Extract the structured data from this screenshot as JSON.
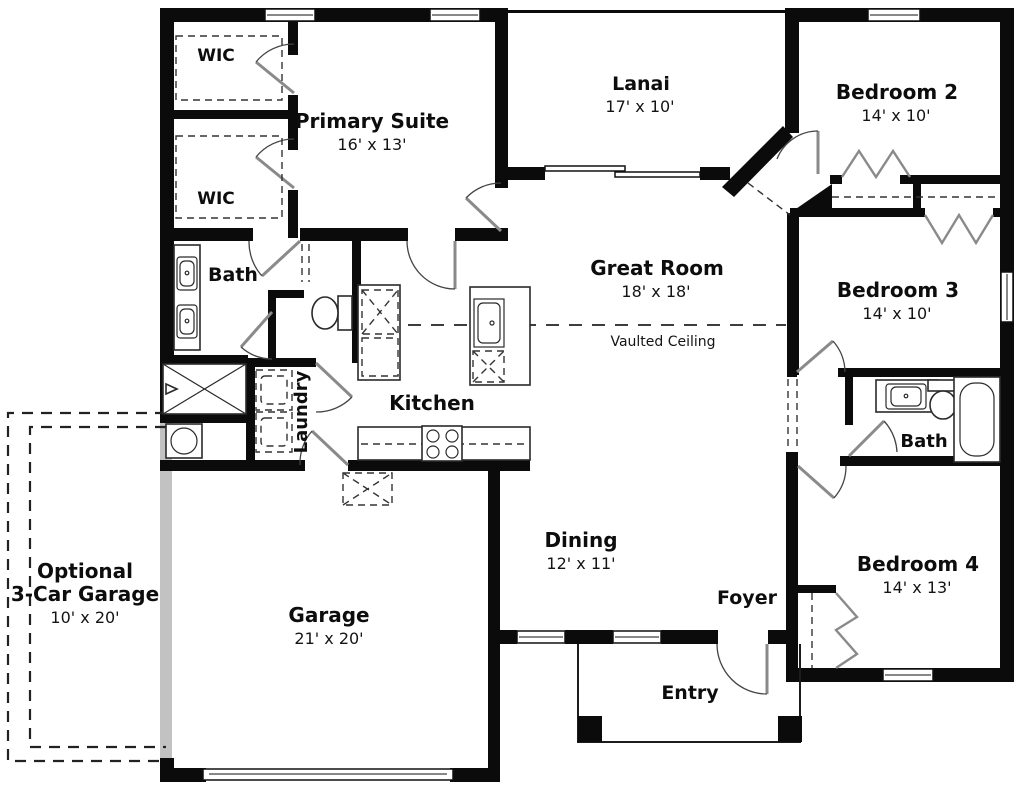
{
  "plan": {
    "title": "Single-story house floor plan",
    "colors": {
      "wall": "#0b0b0b",
      "optional_garage_wall": "#c2c2c2",
      "background": "#ffffff"
    },
    "rooms": {
      "wic1": {
        "name": "WIC"
      },
      "wic2": {
        "name": "WIC"
      },
      "primary": {
        "name": "Primary Suite",
        "dims": "16' x 13'"
      },
      "lanai": {
        "name": "Lanai",
        "dims": "17' x 10'"
      },
      "bedroom2": {
        "name": "Bedroom 2",
        "dims": "14' x 10'"
      },
      "great_room": {
        "name": "Great Room",
        "dims": "18' x 18'",
        "note": "Vaulted Ceiling"
      },
      "bedroom3": {
        "name": "Bedroom 3",
        "dims": "14' x 10'"
      },
      "bath1": {
        "name": "Bath"
      },
      "bath2": {
        "name": "Bath"
      },
      "laundry": {
        "name": "Laundry"
      },
      "kitchen": {
        "name": "Kitchen"
      },
      "dining": {
        "name": "Dining",
        "dims": "12' x 11'"
      },
      "foyer": {
        "name": "Foyer"
      },
      "entry": {
        "name": "Entry"
      },
      "bedroom4": {
        "name": "Bedroom 4",
        "dims": "14' x 13'"
      },
      "garage": {
        "name": "Garage",
        "dims": "21' x 20'"
      },
      "optional_garage": {
        "name_line1": "Optional",
        "name_line2": "3-Car Garage",
        "dims": "10' x 20'"
      }
    }
  }
}
